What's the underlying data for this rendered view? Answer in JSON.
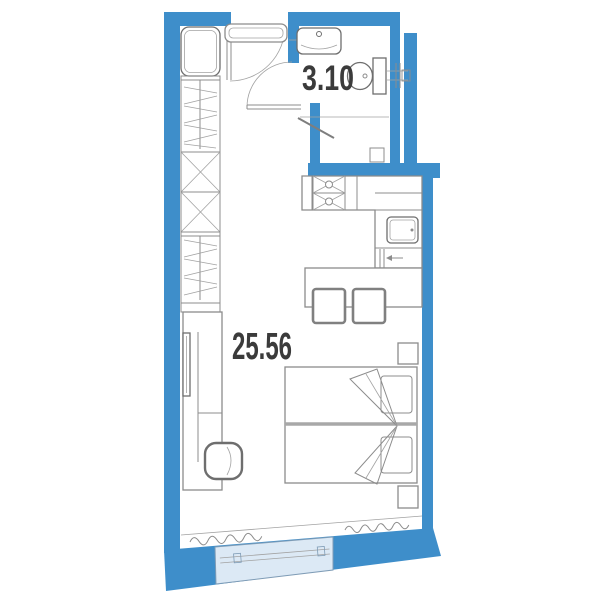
{
  "meta": {
    "type": "floor-plan",
    "description": "studio apartment plan with bathroom, kitchen zone, wardrobe, desk and double bed"
  },
  "labels": {
    "bathroom_area": "3.10",
    "main_area": "25.56"
  },
  "colors": {
    "wall": "#3E8ECA",
    "window_fill": "#DCE9F5",
    "window_border": "#7F9CB6",
    "line": "#8C8C8C",
    "line_dark": "#6E6E6E",
    "text": "#3B3B3B",
    "bed_divider": "#A8A8A8"
  },
  "rooms": [
    {
      "name": "bathroom",
      "area": "3.10"
    },
    {
      "name": "living-kitchen-room",
      "area": "25.56"
    }
  ],
  "fixtures": [
    "entrance-door",
    "bathroom-door",
    "bathroom-sink",
    "toilet",
    "pipe-riser",
    "washing-machine",
    "wardrobe-cabinet",
    "clothes-rail",
    "storage-box-x",
    "stove",
    "kitchen-counter",
    "kitchen-sink",
    "appliance-arrow-marker",
    "bar-table",
    "stool",
    "desk",
    "monitor",
    "desk-chair",
    "double-bed",
    "pillow",
    "folded-blanket",
    "nightstand",
    "radiator",
    "window"
  ]
}
